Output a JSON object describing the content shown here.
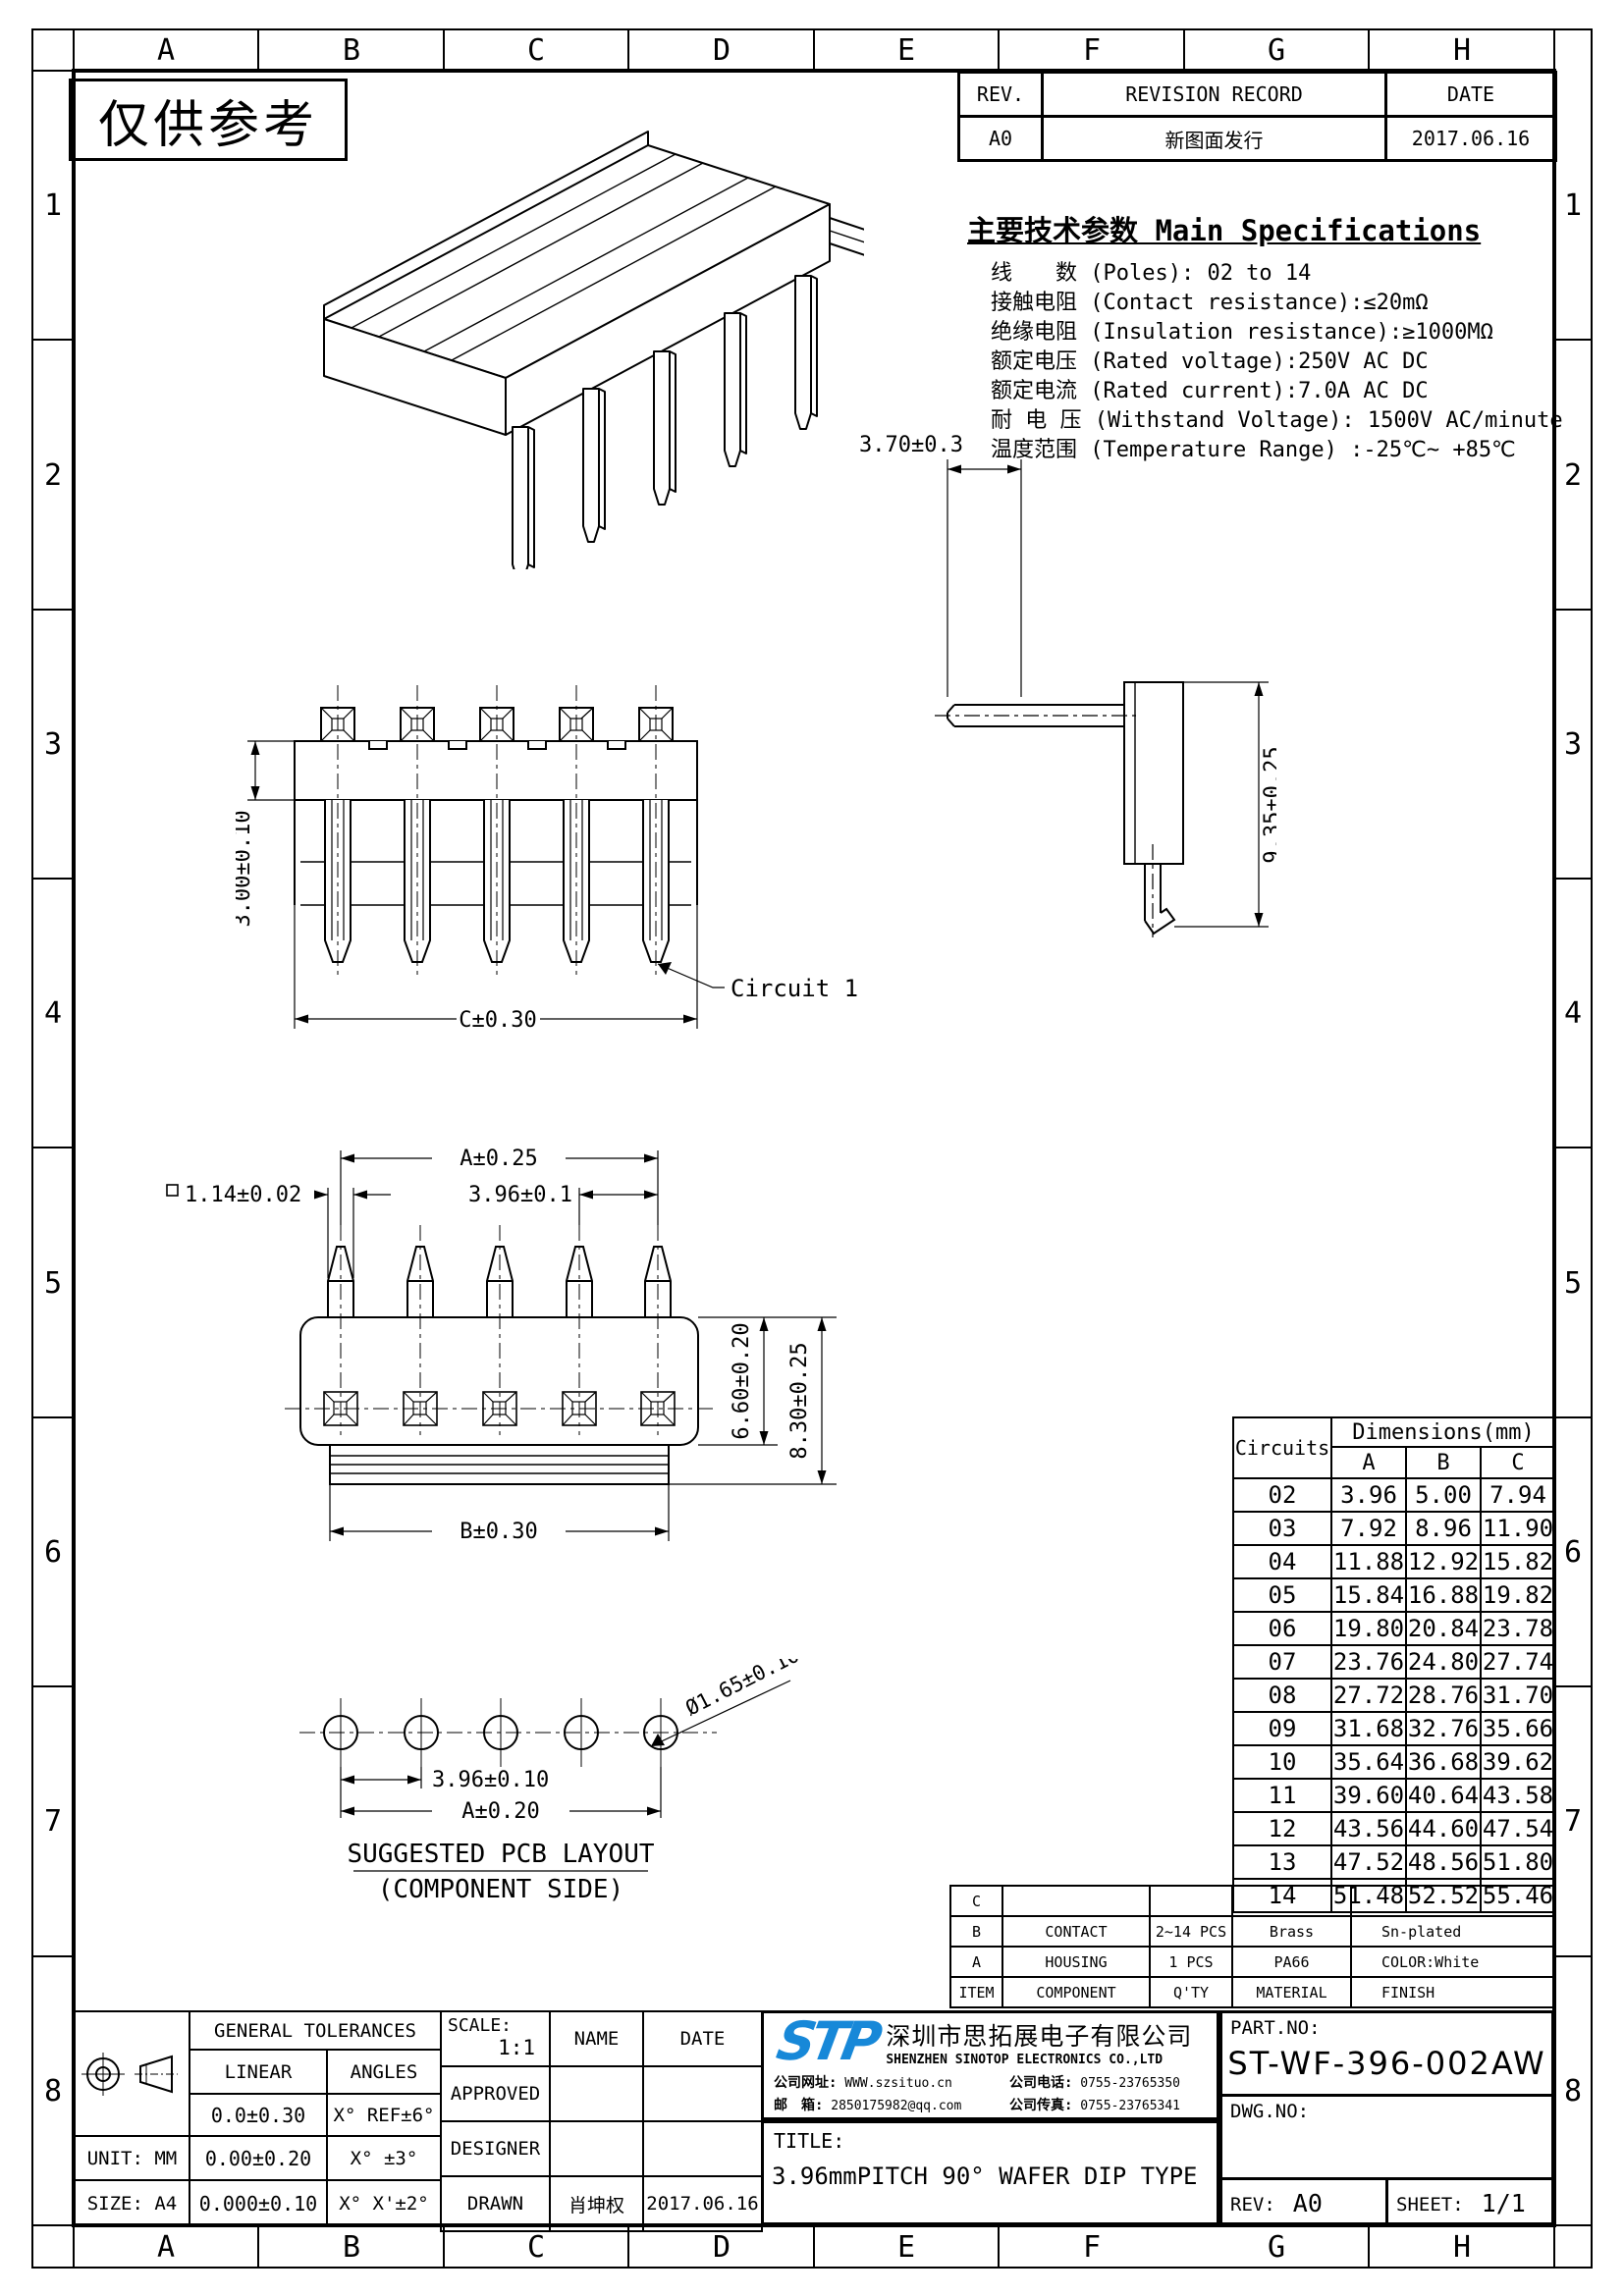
{
  "frame": {
    "cols": [
      "A",
      "B",
      "C",
      "D",
      "E",
      "F",
      "G",
      "H"
    ],
    "rows": [
      "1",
      "2",
      "3",
      "4",
      "5",
      "6",
      "7",
      "8"
    ]
  },
  "stamp": "仅供参考",
  "revision": {
    "rev_h": "REV.",
    "record_h": "REVISION RECORD",
    "date_h": "DATE",
    "rev": "A0",
    "record": "新图面发行",
    "date": "2017.06.16"
  },
  "specs": {
    "title": "主要技术参数 Main Specifications",
    "lines": [
      "线　　数 (Poles): 02 to 14",
      "接触电阻 (Contact resistance):≤20mΩ",
      "绝缘电阻 (Insulation resistance):≥1000MΩ",
      "额定电压 (Rated voltage):250V AC DC",
      "额定电流 (Rated current):7.0A AC DC",
      "耐 电 压 (Withstand Voltage): 1500V AC/minute",
      "温度范围 (Temperature Range) :-25℃~ +85℃"
    ]
  },
  "views": {
    "front": {
      "height": "3.00±0.10",
      "width": "C±0.30",
      "circuit": "Circuit 1"
    },
    "side": {
      "tail": "3.70±0.3",
      "depth": "9.35±0.25"
    },
    "bottom": {
      "a": "A±0.25",
      "pitch": "3.96±0.1",
      "pin": "1.14±0.02",
      "body": "6.60±0.20",
      "total": "8.30±0.25",
      "b": "B±0.30"
    },
    "pcb": {
      "hole": "Ø1.65±0.10",
      "pitch": "3.96±0.10",
      "a": "A±0.20",
      "caption": "SUGGESTED PCB LAYOUT",
      "caption2": "(COMPONENT SIDE)"
    }
  },
  "dim_table": {
    "circuits_h": "Circuits",
    "group_h": "Dimensions(mm)",
    "col_a": "A",
    "col_b": "B",
    "col_c": "C",
    "rows": [
      [
        "02",
        "3.96",
        "5.00",
        "7.94"
      ],
      [
        "03",
        "7.92",
        "8.96",
        "11.90"
      ],
      [
        "04",
        "11.88",
        "12.92",
        "15.82"
      ],
      [
        "05",
        "15.84",
        "16.88",
        "19.82"
      ],
      [
        "06",
        "19.80",
        "20.84",
        "23.78"
      ],
      [
        "07",
        "23.76",
        "24.80",
        "27.74"
      ],
      [
        "08",
        "27.72",
        "28.76",
        "31.70"
      ],
      [
        "09",
        "31.68",
        "32.76",
        "35.66"
      ],
      [
        "10",
        "35.64",
        "36.68",
        "39.62"
      ],
      [
        "11",
        "39.60",
        "40.64",
        "43.58"
      ],
      [
        "12",
        "43.56",
        "44.60",
        "47.54"
      ],
      [
        "13",
        "47.52",
        "48.56",
        "51.80"
      ],
      [
        "14",
        "51.48",
        "52.52",
        "55.46"
      ]
    ]
  },
  "bom": {
    "rows": [
      [
        "C",
        "",
        "",
        "",
        ""
      ],
      [
        "B",
        "CONTACT",
        "2~14 PCS",
        "Brass",
        "Sn-plated"
      ],
      [
        "A",
        "HOUSING",
        "1 PCS",
        "PA66",
        "COLOR:White"
      ],
      [
        "ITEM",
        "COMPONENT",
        "Q'TY",
        "MATERIAL",
        "FINISH"
      ]
    ]
  },
  "tolerances": {
    "title": "GENERAL TOLERANCES",
    "linear_h": "LINEAR",
    "angles_h": "ANGLES",
    "r1_lin": "0.0±0.30",
    "r1_ang": "X° REF±6°",
    "unit": "UNIT: MM",
    "r2_lin": "0.00±0.20",
    "r2_ang": "X° ±3°",
    "size": "SIZE: A4",
    "r3_lin": "0.000±0.10",
    "r3_ang": "X° X'±2°"
  },
  "approval": {
    "scale_label": "SCALE:",
    "scale": "1:1",
    "name_h": "NAME",
    "date_h": "DATE",
    "approved": "APPROVED",
    "designer": "DESIGNER",
    "drawn": "DRAWN",
    "drawn_name": "肖坤权",
    "drawn_date": "2017.06.16"
  },
  "company": {
    "logo_text": "STP",
    "logo_color": "#1788D8",
    "name_cn": "深圳市思拓展电子有限公司",
    "name_en": "SHENZHEN SINOTOP ELECTRONICS CO.,LTD",
    "web_label": "公司网址:",
    "web": "WWW.szsituo.cn",
    "tel_label": "公司电话:",
    "tel": "0755-23765350",
    "mail_label": "邮　箱:",
    "mail": "2850175982@qq.com",
    "fax_label": "公司传真:",
    "fax": "0755-23765341"
  },
  "title_block": {
    "label": "TITLE:",
    "title": "3.96mmPITCH 90° WAFER DIP TYPE"
  },
  "part": {
    "part_label": "PART.NO:",
    "part_no": "ST-WF-396-002AW",
    "dwg_label": "DWG.NO:",
    "rev_label": "REV:",
    "rev": "A0",
    "sheet_label": "SHEET:",
    "sheet": "1/1"
  }
}
